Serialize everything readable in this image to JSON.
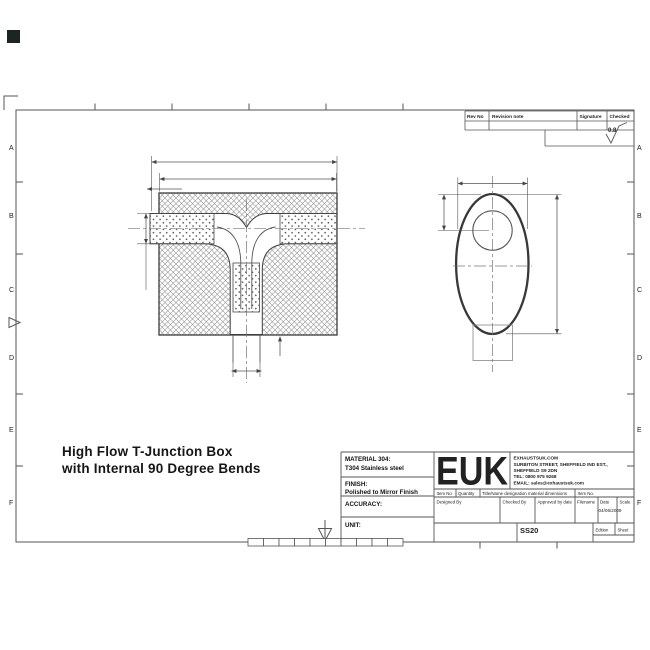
{
  "drawing": {
    "title_line1": "High Flow T-Junction Box",
    "title_line2": "with Internal 90 Degree Bends"
  },
  "border": {
    "rows": [
      "A",
      "B",
      "C",
      "D",
      "E",
      "F"
    ]
  },
  "rev_table": {
    "col1": "Rev No",
    "col2": "Revision note",
    "col3": "Signature",
    "col4": "Checked",
    "surface_finish": "0.8"
  },
  "title_block": {
    "material_label": "MATERIAL 304:",
    "material_value": "T304 Stainless steel",
    "finish_label": "FINISH:",
    "finish_value": "Polished to Mirror Finish",
    "accuracy_label": "ACCURACY:",
    "unit_label": "UNIT:",
    "logo": "EUK",
    "website": "EXHAUSTSUK.COM",
    "address1": "SURBITON STREET, SHEFFIELD IND EST.,",
    "address2": "SHEFFIELD S9 2DN",
    "tel": "TEL: 0800 975 9268",
    "email": "EMAIL: sales@exhaustsuk.com",
    "item_no": "Item No",
    "quantity": "Quantity",
    "title_name": "Title/Name designation material dimensions",
    "item_no2": "Item No.",
    "designed_by": "Designed By",
    "checked_by": "Checked By",
    "approved_by": "Approved by date",
    "filename": "Filename",
    "date_label": "Date",
    "scale_label": "Scale",
    "date_value": "04/06/2009",
    "part_number": "SS20",
    "edition": "Edition",
    "sheet": "Sheet"
  },
  "colors": {
    "line": "#4a4a4a",
    "corner_square": "#1b2620"
  }
}
